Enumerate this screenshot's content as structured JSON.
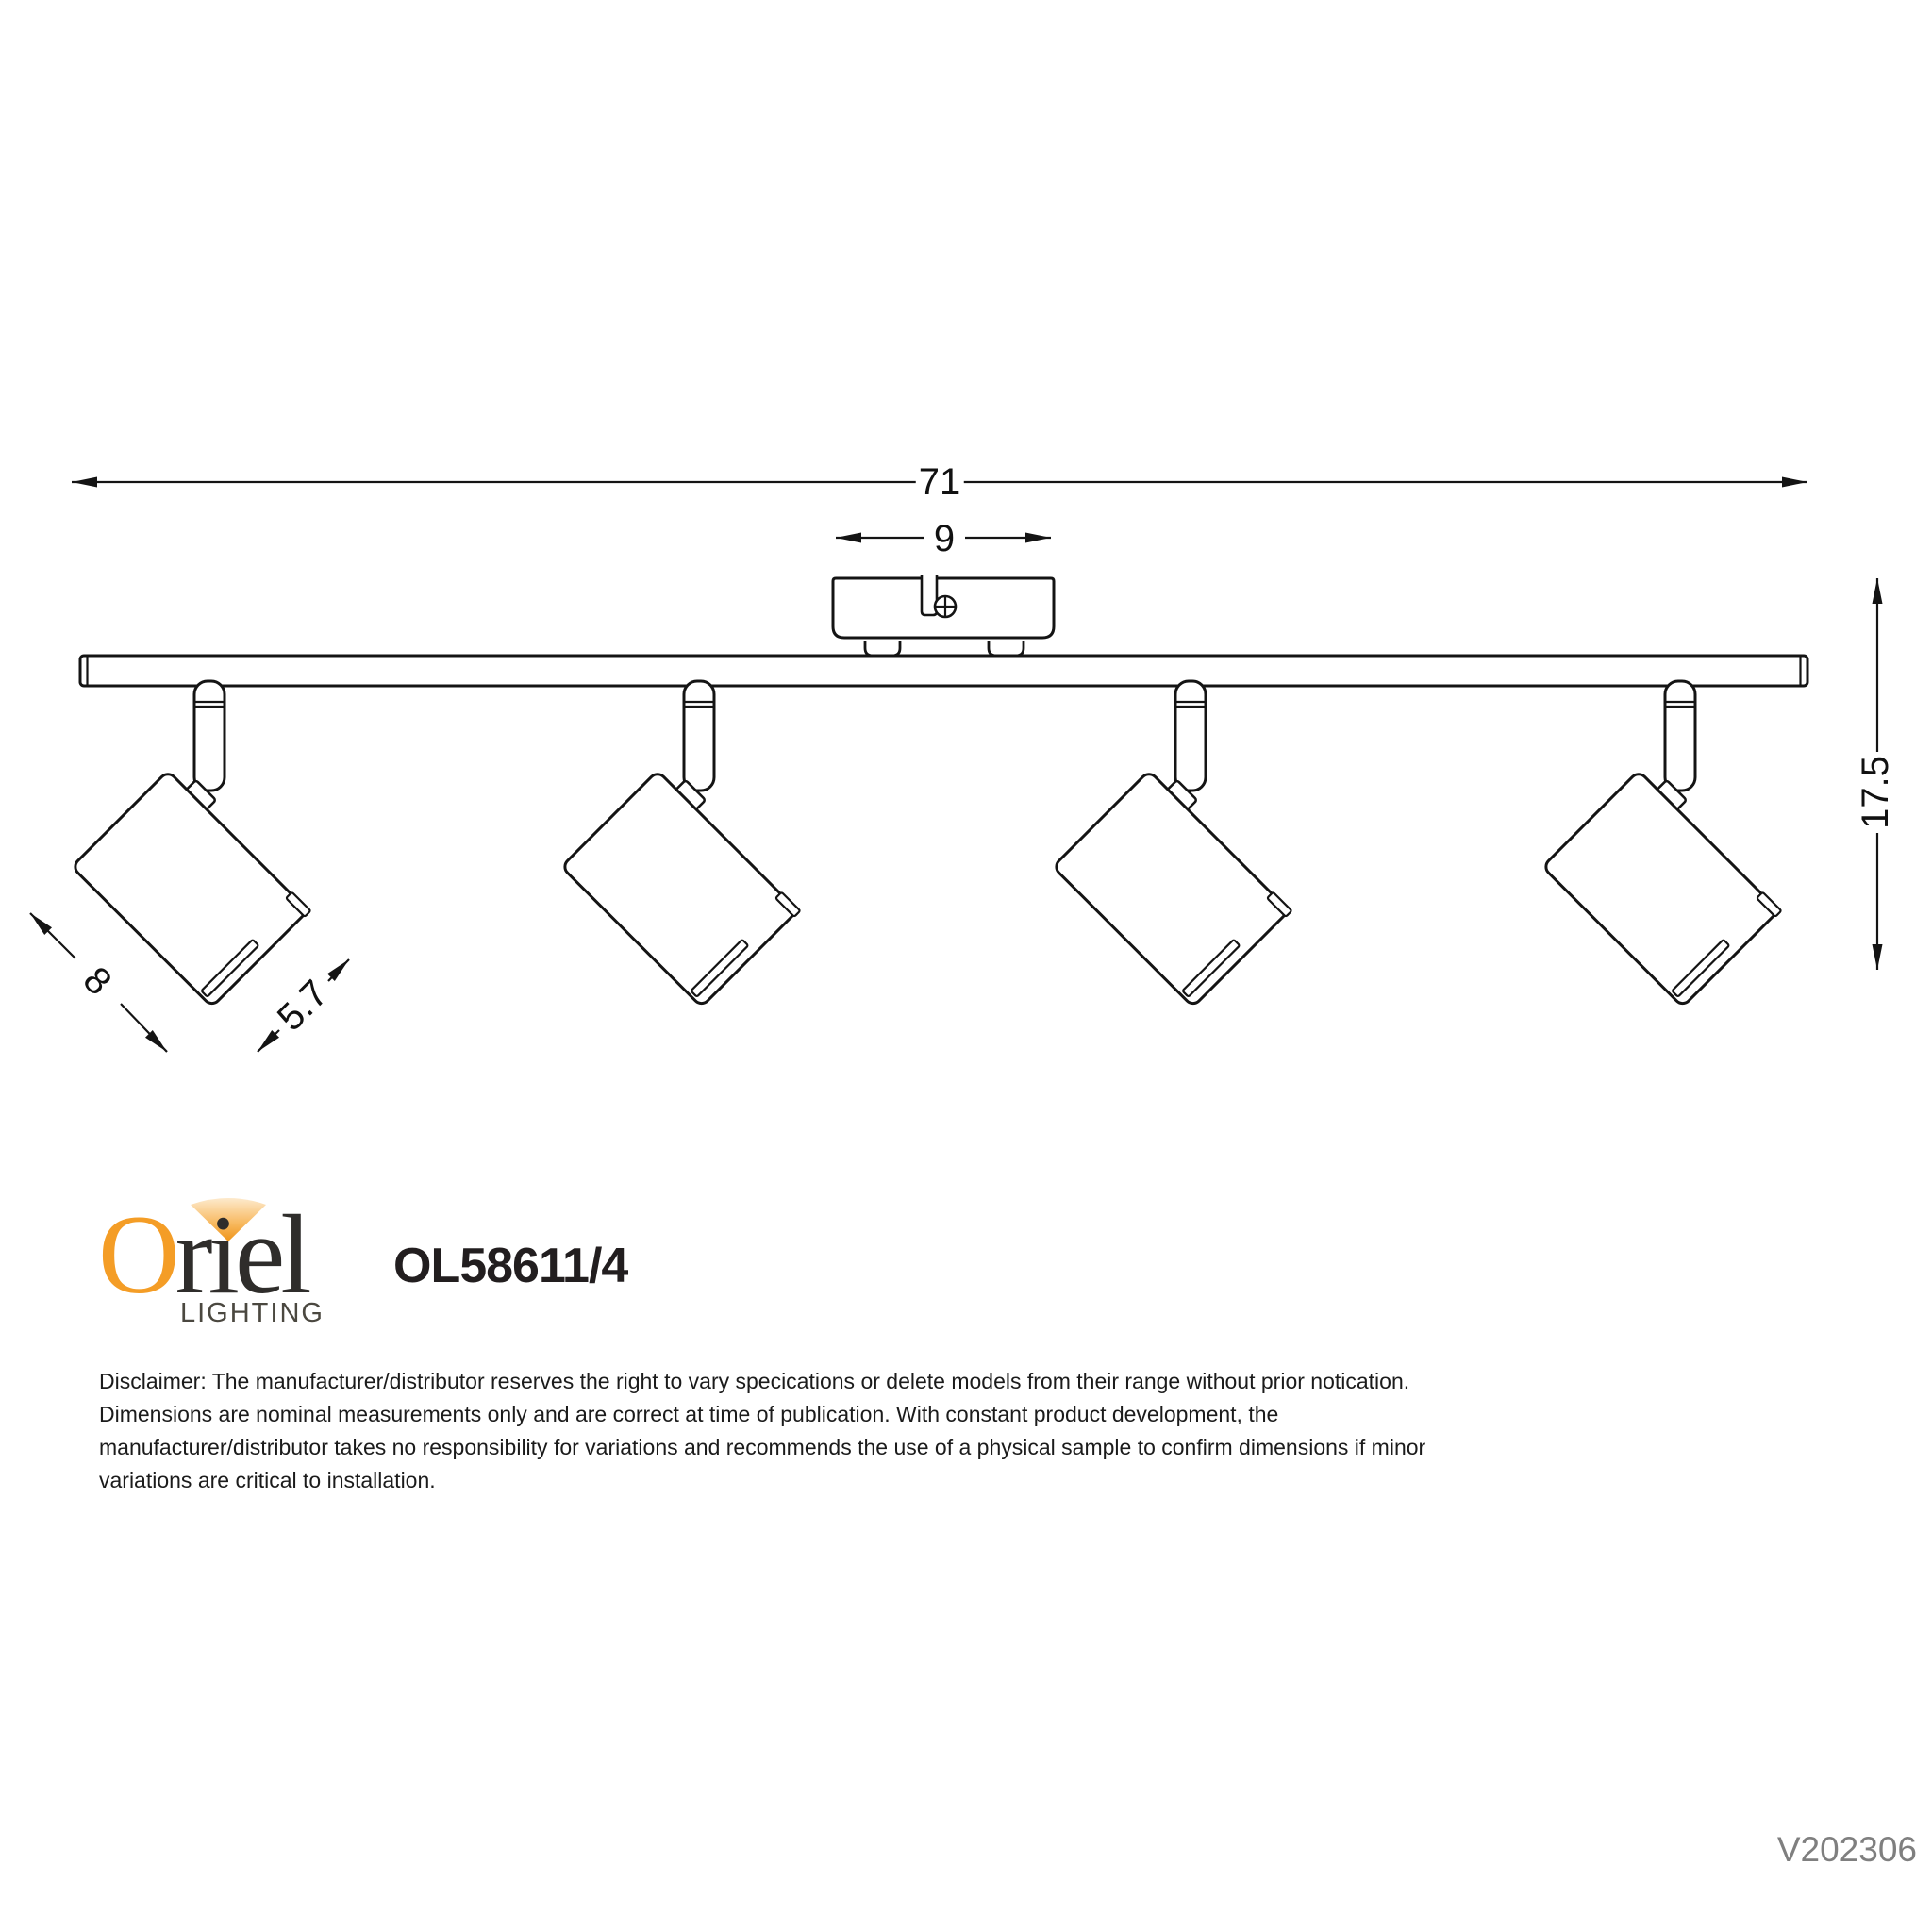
{
  "drawing": {
    "type": "technical-dimension-diagram",
    "subject": "4-light adjustable ceiling spotlight bar",
    "dim_total_length": "71",
    "dim_canopy_length": "9",
    "dim_height": "17.5",
    "dim_head_length": "8",
    "dim_head_width": "5.7",
    "line_color": "#141414"
  },
  "logo": {
    "initial": "O",
    "rest": "riel",
    "tagline": "LIGHTING",
    "orange": "#F49D26",
    "dark": "#2F2D2B"
  },
  "product_code": "OL58611/4",
  "version_code": "V202306",
  "disclaimer": {
    "line1": "Disclaimer: The manufacturer/distributor reserves the right to vary specications or delete models from their range without prior notication.",
    "line2": "Dimensions are nominal measurements only and are correct at time of publication. With constant product development, the",
    "line3": "manufacturer/distributor takes no responsibility for variations and recommends the use of a physical sample to confirm dimensions if minor",
    "line4": "variations are critical to installation."
  }
}
